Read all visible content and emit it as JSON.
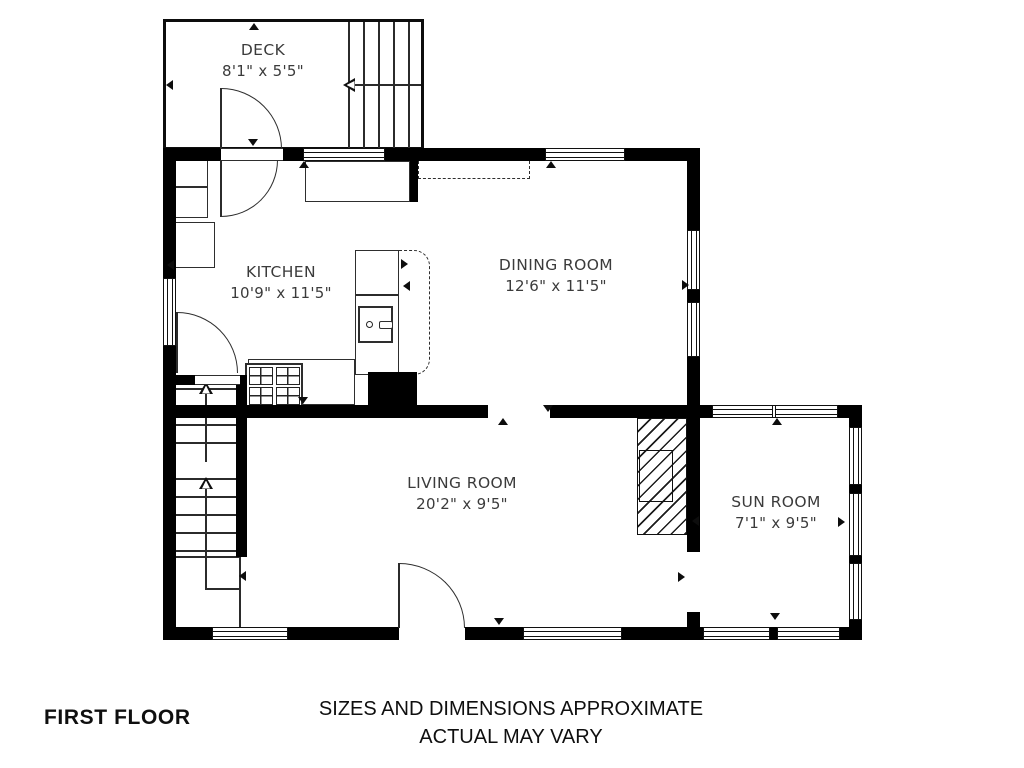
{
  "page": {
    "floor_label": "FIRST FLOOR",
    "disclaimer_line1": "SIZES AND DIMENSIONS APPROXIMATE",
    "disclaimer_line2": "ACTUAL MAY VARY"
  },
  "rooms": {
    "deck": {
      "name": "DECK",
      "dimensions": "8'1\" x 5'5\""
    },
    "kitchen": {
      "name": "KITCHEN",
      "dimensions": "10'9\" x 11'5\""
    },
    "dining_room": {
      "name": "DINING ROOM",
      "dimensions": "12'6\" x 11'5\""
    },
    "living_room": {
      "name": "LIVING ROOM",
      "dimensions": "20'2\" x 9'5\""
    },
    "sun_room": {
      "name": "SUN ROOM",
      "dimensions": "7'1\" x 9'5\""
    }
  },
  "colors": {
    "wall": "#000000",
    "line": "#2e2e2e",
    "text": "#3b3b3b",
    "background": "#ffffff"
  }
}
